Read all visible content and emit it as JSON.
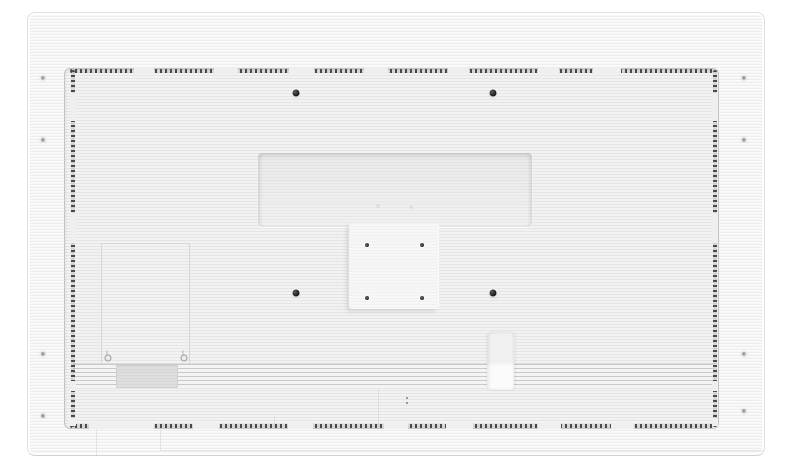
{
  "scene": {
    "description": "Product photo: rear view of a white flat-panel display with perforated vent border, VESA mount area, vent slats and screw holes",
    "background_color": "#ffffff",
    "colors": {
      "body": "#f7f7f7",
      "panel": "#f2f2f2",
      "outline": "#c4c4c4",
      "perforation": "#4a4a4a",
      "slat": "#c9c9c9",
      "label": "#dedede"
    }
  },
  "device": {
    "x": 27,
    "y": 12,
    "w": 738,
    "h": 444
  },
  "features": {
    "inner_panel": {
      "x": 36,
      "y": 55,
      "w": 655,
      "h": 361
    },
    "vesa_recess": {
      "x": 230,
      "y": 140,
      "w": 274,
      "h": 74
    },
    "vesa_plate": {
      "x": 321,
      "y": 210,
      "w": 90,
      "h": 86
    },
    "service_panel": {
      "x": 73,
      "y": 230,
      "w": 89,
      "h": 122
    },
    "vent_slats": {
      "x": 45,
      "y": 350,
      "w": 640,
      "h": 26
    },
    "product_label": {
      "x": 88,
      "y": 352,
      "w": 62,
      "h": 23
    },
    "cable_notch": {
      "x": 459,
      "y": 319,
      "w": 27,
      "h": 58
    },
    "perf_top": {
      "x": 42,
      "y": 56,
      "w": 643,
      "h": 4
    },
    "perf_bottom": {
      "x": 42,
      "y": 411,
      "w": 643,
      "h": 4
    },
    "perf_left": {
      "x": 43,
      "y": 57,
      "w": 4,
      "h": 357
    },
    "perf_right": {
      "x": 685,
      "y": 57,
      "w": 4,
      "h": 357
    }
  },
  "perforation_gaps": {
    "top": [
      [
        64,
        20
      ],
      [
        144,
        24
      ],
      [
        219,
        25
      ],
      [
        294,
        24
      ],
      [
        378,
        21
      ],
      [
        468,
        21
      ],
      [
        523,
        28
      ]
    ],
    "bottom": [
      [
        19,
        65
      ],
      [
        123,
        26
      ],
      [
        218,
        25
      ],
      [
        314,
        24
      ],
      [
        376,
        27
      ],
      [
        468,
        23
      ],
      [
        541,
        23
      ]
    ],
    "left": [
      [
        23,
        28
      ],
      [
        143,
        30
      ],
      [
        311,
        10
      ],
      [
        348,
        8
      ]
    ],
    "right": [
      [
        23,
        28
      ],
      [
        143,
        30
      ],
      [
        311,
        10
      ],
      [
        348,
        8
      ]
    ]
  },
  "screws": [
    {
      "type": "large",
      "name": "wall-mount-screw-hole",
      "x": 268,
      "y": 80
    },
    {
      "type": "large",
      "name": "wall-mount-screw-hole",
      "x": 465,
      "y": 80
    },
    {
      "type": "large",
      "name": "wall-mount-screw-hole",
      "x": 268,
      "y": 280
    },
    {
      "type": "large",
      "name": "wall-mount-screw-hole",
      "x": 465,
      "y": 280
    },
    {
      "type": "vesa",
      "name": "vesa-screw-hole",
      "x": 339,
      "y": 232
    },
    {
      "type": "vesa",
      "name": "vesa-screw-hole",
      "x": 394,
      "y": 232
    },
    {
      "type": "vesa",
      "name": "vesa-screw-hole",
      "x": 339,
      "y": 285
    },
    {
      "type": "vesa",
      "name": "vesa-screw-hole",
      "x": 394,
      "y": 285
    },
    {
      "type": "bezel",
      "name": "bezel-screw",
      "x": 15,
      "y": 65
    },
    {
      "type": "bezel",
      "name": "bezel-screw",
      "x": 15,
      "y": 127
    },
    {
      "type": "bezel",
      "name": "bezel-screw",
      "x": 15,
      "y": 341
    },
    {
      "type": "bezel",
      "name": "bezel-screw",
      "x": 15,
      "y": 403
    },
    {
      "type": "bezel",
      "name": "bezel-screw",
      "x": 716,
      "y": 65
    },
    {
      "type": "bezel",
      "name": "bezel-screw",
      "x": 716,
      "y": 127
    },
    {
      "type": "bezel",
      "name": "bezel-screw",
      "x": 716,
      "y": 341
    },
    {
      "type": "bezel",
      "name": "bezel-screw",
      "x": 716,
      "y": 398
    },
    {
      "type": "subpanel",
      "name": "service-panel-screw",
      "x": 80,
      "y": 345
    },
    {
      "type": "subpanel",
      "name": "service-panel-screw",
      "x": 156,
      "y": 345
    },
    {
      "type": "tiny",
      "name": "pinhole",
      "x": 379,
      "y": 385
    },
    {
      "type": "tiny",
      "name": "pinhole",
      "x": 379,
      "y": 390
    },
    {
      "type": "faint",
      "name": "recess-mark",
      "x": 350,
      "y": 193
    },
    {
      "type": "faint",
      "name": "recess-mark",
      "x": 383,
      "y": 194
    }
  ],
  "seams": [
    {
      "x": 350,
      "y": 376,
      "w": 1,
      "h": 37
    },
    {
      "x": 246,
      "y": 403,
      "w": 1,
      "h": 13
    },
    {
      "x": 68,
      "y": 416,
      "w": 1,
      "h": 27
    },
    {
      "x": 132,
      "y": 416,
      "w": 1,
      "h": 21
    },
    {
      "x": 132,
      "y": 437,
      "w": 604,
      "h": 1
    }
  ]
}
